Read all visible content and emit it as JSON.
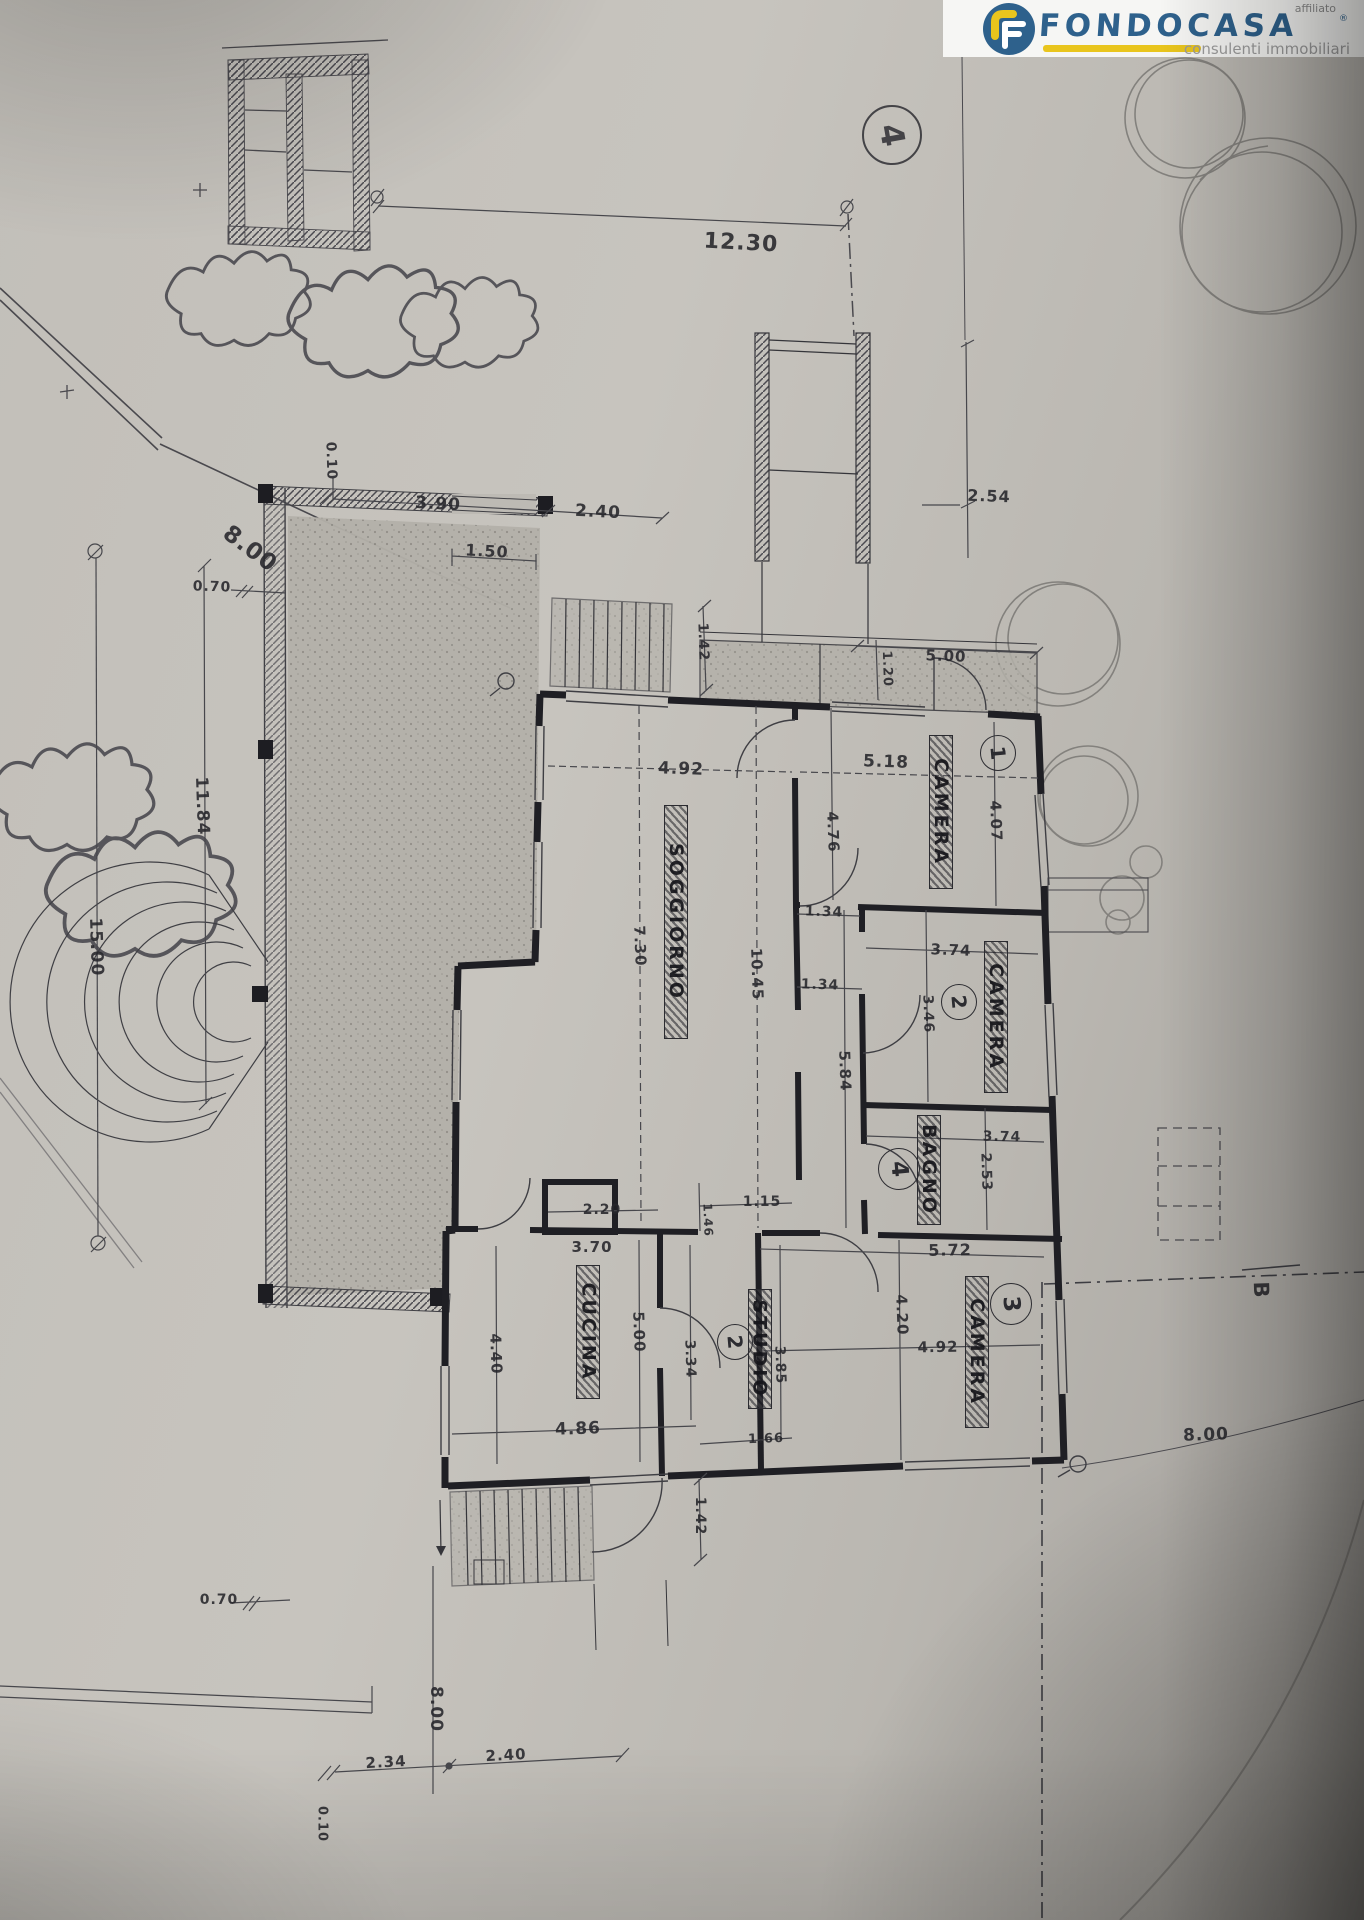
{
  "photo": {
    "paper_color": "#c2bfb9",
    "line_color": "#3a3a3f",
    "wall_color": "#1f1f24"
  },
  "logo": {
    "brand": "FONDOCASA",
    "affiliato_label": "affiliato",
    "registered_mark": "®",
    "tagline": "consulenti immobiliari",
    "brand_color": "#2e618c",
    "accent_color": "#e9c51d",
    "icon_name": "fondocasa-f-icon"
  },
  "sheet": {
    "number": "4"
  },
  "plan": {
    "room_labels": [
      {
        "t": "SOGGIORNO",
        "x": 676,
        "y": 922,
        "len": 232
      },
      {
        "t": "CUCINA",
        "x": 588,
        "y": 1332,
        "len": 132
      },
      {
        "t": "STUDIO",
        "x": 760,
        "y": 1349,
        "len": 118
      },
      {
        "t": "BAGNO",
        "x": 929,
        "y": 1170,
        "len": 108
      },
      {
        "t": "CAMERA",
        "x": 941,
        "y": 812,
        "len": 152
      },
      {
        "t": "CAMERA",
        "x": 996,
        "y": 1017,
        "len": 150
      },
      {
        "t": "CAMERA",
        "x": 977,
        "y": 1352,
        "len": 150
      }
    ],
    "room_marks": [
      {
        "n": "1",
        "x": 998,
        "y": 753,
        "d": 34
      },
      {
        "n": "2",
        "x": 959,
        "y": 1002,
        "d": 34
      },
      {
        "n": "3",
        "x": 1011,
        "y": 1304,
        "d": 40
      },
      {
        "n": "4",
        "x": 899,
        "y": 1169,
        "d": 40
      },
      {
        "n": "2",
        "x": 735,
        "y": 1342,
        "d": 34
      }
    ],
    "dim_labels": [
      {
        "t": "12.30",
        "x": 741,
        "y": 243,
        "r": 3,
        "s": 22
      },
      {
        "t": "2.54",
        "x": 989,
        "y": 496,
        "r": 2,
        "s": 16
      },
      {
        "t": "0.10",
        "x": 331,
        "y": 461,
        "r": 88,
        "s": 14
      },
      {
        "t": "3.90",
        "x": 438,
        "y": 504,
        "r": 3,
        "s": 17
      },
      {
        "t": "2.40",
        "x": 598,
        "y": 512,
        "r": 3,
        "s": 17
      },
      {
        "t": "8.00",
        "x": 250,
        "y": 549,
        "r": 37,
        "s": 23
      },
      {
        "t": "1.50",
        "x": 487,
        "y": 551,
        "r": 3,
        "s": 16
      },
      {
        "t": "0.70",
        "x": 212,
        "y": 587,
        "r": 2,
        "s": 14
      },
      {
        "t": "1.42",
        "x": 703,
        "y": 642,
        "r": 88,
        "s": 14
      },
      {
        "t": "5.00",
        "x": 946,
        "y": 656,
        "r": 2,
        "s": 15
      },
      {
        "t": "1.20",
        "x": 887,
        "y": 669,
        "r": 88,
        "s": 13
      },
      {
        "t": "5.18",
        "x": 886,
        "y": 762,
        "r": 2,
        "s": 17
      },
      {
        "t": "4.92",
        "x": 681,
        "y": 769,
        "r": 2,
        "s": 17
      },
      {
        "t": "4.07",
        "x": 996,
        "y": 821,
        "r": 88,
        "s": 15
      },
      {
        "t": "4.76",
        "x": 833,
        "y": 832,
        "r": 88,
        "s": 15
      },
      {
        "t": "11.84",
        "x": 202,
        "y": 806,
        "r": 88,
        "s": 17
      },
      {
        "t": "15.00",
        "x": 96,
        "y": 947,
        "r": 88,
        "s": 17
      },
      {
        "t": "1.34",
        "x": 824,
        "y": 912,
        "r": 2,
        "s": 14
      },
      {
        "t": "3.74",
        "x": 951,
        "y": 950,
        "r": 2,
        "s": 15
      },
      {
        "t": "7.30",
        "x": 640,
        "y": 946,
        "r": 88,
        "s": 15
      },
      {
        "t": "10.45",
        "x": 757,
        "y": 974,
        "r": 88,
        "s": 15
      },
      {
        "t": "1.34",
        "x": 820,
        "y": 985,
        "r": 2,
        "s": 14
      },
      {
        "t": "3.46",
        "x": 928,
        "y": 1014,
        "r": 88,
        "s": 14
      },
      {
        "t": "5.84",
        "x": 845,
        "y": 1071,
        "r": 88,
        "s": 15
      },
      {
        "t": "3.74",
        "x": 1002,
        "y": 1137,
        "r": 1,
        "s": 14
      },
      {
        "t": "2.53",
        "x": 986,
        "y": 1172,
        "r": 88,
        "s": 14
      },
      {
        "t": "1.15",
        "x": 762,
        "y": 1202,
        "r": 0,
        "s": 14
      },
      {
        "t": "2.20",
        "x": 602,
        "y": 1210,
        "r": 0,
        "s": 14
      },
      {
        "t": "1.46",
        "x": 708,
        "y": 1220,
        "r": 88,
        "s": 12
      },
      {
        "t": "3.70",
        "x": 592,
        "y": 1247,
        "r": 0,
        "s": 15
      },
      {
        "t": "5.72",
        "x": 950,
        "y": 1250,
        "r": -1,
        "s": 16
      },
      {
        "t": "4.20",
        "x": 902,
        "y": 1315,
        "r": 88,
        "s": 15
      },
      {
        "t": "4.92",
        "x": 938,
        "y": 1347,
        "r": -1,
        "s": 15
      },
      {
        "t": "5.00",
        "x": 639,
        "y": 1332,
        "r": 88,
        "s": 15
      },
      {
        "t": "3.34",
        "x": 690,
        "y": 1359,
        "r": 88,
        "s": 14
      },
      {
        "t": "4.40",
        "x": 496,
        "y": 1354,
        "r": 88,
        "s": 15
      },
      {
        "t": "3.85",
        "x": 780,
        "y": 1365,
        "r": 88,
        "s": 14
      },
      {
        "t": "4.86",
        "x": 578,
        "y": 1429,
        "r": -2,
        "s": 17
      },
      {
        "t": "1.66",
        "x": 766,
        "y": 1439,
        "r": -2,
        "s": 13
      },
      {
        "t": "8.00",
        "x": 1206,
        "y": 1435,
        "r": -2,
        "s": 17
      },
      {
        "t": "1.42",
        "x": 700,
        "y": 1516,
        "r": 90,
        "s": 14
      },
      {
        "t": "0.70",
        "x": 219,
        "y": 1600,
        "r": 0,
        "s": 14
      },
      {
        "t": "8.00",
        "x": 436,
        "y": 1709,
        "r": 90,
        "s": 17
      },
      {
        "t": "2.34",
        "x": 386,
        "y": 1762,
        "r": -3,
        "s": 15
      },
      {
        "t": "2.40",
        "x": 506,
        "y": 1755,
        "r": -3,
        "s": 15
      },
      {
        "t": "0.10",
        "x": 322,
        "y": 1824,
        "r": 90,
        "s": 13
      },
      {
        "t": "B",
        "x": 1261,
        "y": 1290,
        "r": 88,
        "s": 21
      }
    ]
  }
}
